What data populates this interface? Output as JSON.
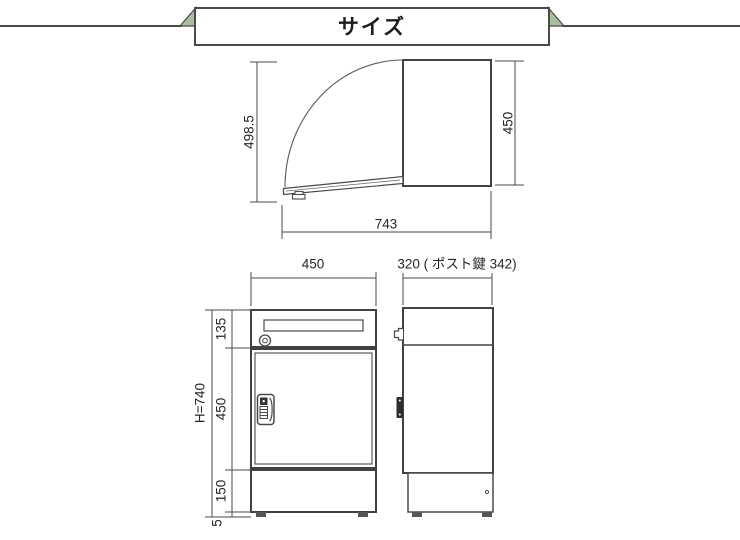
{
  "header": {
    "title": "サイズ"
  },
  "colors": {
    "line": "#4a4a4a",
    "text": "#262626",
    "ribbon_fold": "#a9bea1",
    "handle_dark": "#2e2e2e",
    "background": "#ffffff"
  },
  "drawings": {
    "lid_open_side_view": {
      "dim_lid_length": "498.5",
      "dim_body_height": "450",
      "dim_total_depth": "743"
    },
    "front_view": {
      "dim_width": "450",
      "dim_total_height": "H=740",
      "dim_top_section": "135",
      "dim_door_section": "450",
      "dim_base_section": "150",
      "dim_foot": "5"
    },
    "side_view": {
      "dim_depth": "320 ( ポスト鍵 342)"
    }
  }
}
